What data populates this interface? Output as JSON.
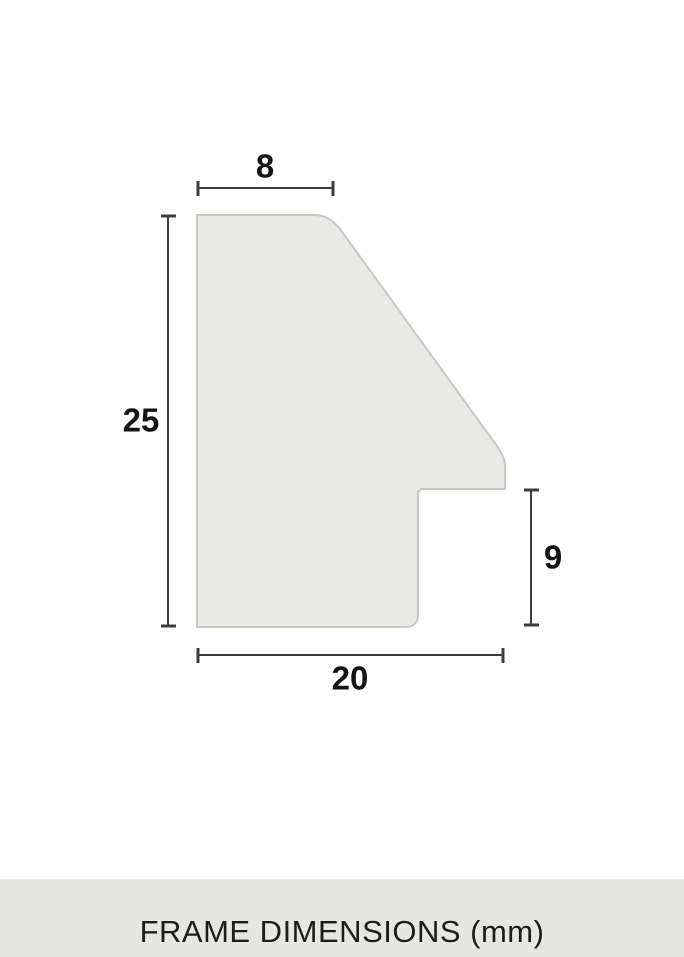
{
  "diagram": {
    "labels": {
      "top_width": "8",
      "overall_height": "25",
      "rabbet_height": "9",
      "bottom_width": "20"
    }
  },
  "footer": {
    "caption": "FRAME DIMENSIONS (mm)"
  },
  "colors": {
    "background": "#ffffff",
    "shape_fill": "#e9e9e5",
    "shape_outline": "#c7c7c3",
    "dimension_line": "#3d3d3b",
    "label_text": "#141412",
    "footer_band": "#e6e6e2",
    "footer_text": "#1d1d1b"
  }
}
